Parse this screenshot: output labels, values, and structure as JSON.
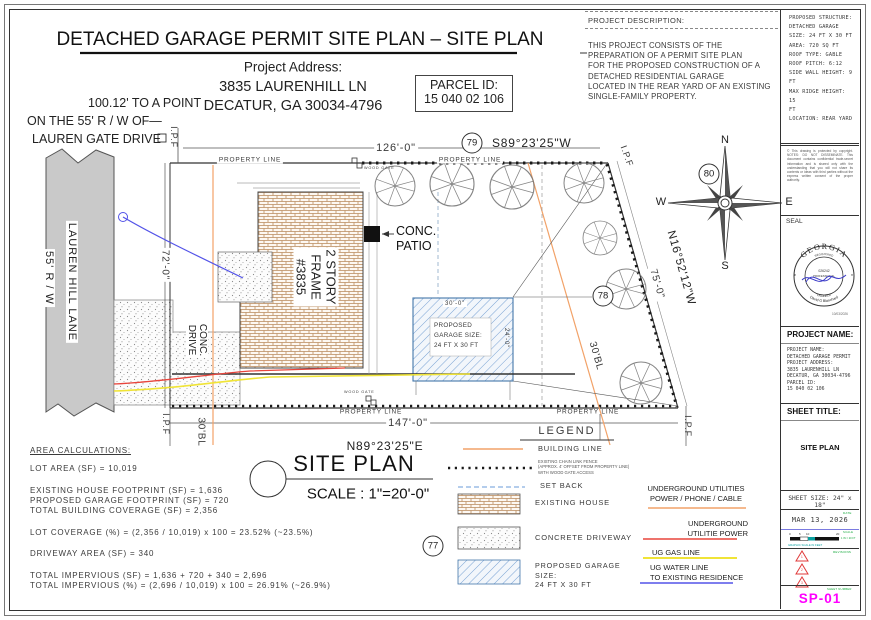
{
  "header": {
    "title": "DETACHED GARAGE PERMIT SITE PLAN – SITE PLAN",
    "address_label": "Project Address:",
    "address_line1": "3835 LAURENHILL LN",
    "address_line2": "DECATUR, GA 30034-4796",
    "parcel_label": "PARCEL ID:",
    "parcel_value": "15 040 02 106",
    "description_label": "PROJECT DESCRIPTION:",
    "description_lines": [
      "THIS PROJECT CONSISTS OF THE",
      "PREPARATION OF A PERMIT SITE PLAN",
      "FOR THE PROPOSED CONSTRUCTION OF A",
      "DETACHED RESIDENTIAL GARAGE",
      "LOCATED IN THE REAR YARD OF AN EXISTING",
      "SINGLE-FAMILY PROPERTY."
    ],
    "left_note_line1": "100.12' TO A POINT",
    "left_note_line2": "ON THE 55' R / W OF—",
    "left_note_line3": "LAUREN GATE DRIVE"
  },
  "drawing": {
    "property_line": "PROPERTY LINE",
    "ipf": "I.P.F",
    "dim_top": "126'-0\"",
    "dim_bottom": "147'-0\"",
    "dim_left": "72'-0\"",
    "dim_right": "75'-0\"",
    "bearing_top": "S89°23'25\"W",
    "bearing_bottom": "N89°23'25\"E",
    "bearing_right": "N16°52'12\"W",
    "bl_label": "30'BL",
    "road_name": "LAUREN HILL LANE",
    "road_rw": "55' R / W",
    "house_line1": "2 STORY",
    "house_line2": "FRAME",
    "house_line3": "#3835",
    "conc_drive_line1": "CONC.",
    "conc_drive_line2": "DRIVE",
    "conc_patio_line1": "CONC.",
    "conc_patio_line2": "PATIO",
    "garage_dim_w": "30'-0\"",
    "garage_dim_h": "24'-0\"",
    "garage_line1": "PROPOSED",
    "garage_line2": "GARAGE SIZE:",
    "garage_line3": "24 FT X 30 FT",
    "wood_gate": "WOOD GATE",
    "circle_77": "77",
    "circle_78": "78",
    "circle_79": "79",
    "circle_80": "80",
    "compass_n": "N",
    "compass_e": "E",
    "compass_s": "S",
    "compass_w": "W",
    "site_plan_title": "SITE PLAN",
    "site_plan_scale": "SCALE : 1\"=20'-0\"",
    "area_calcs": {
      "title": "AREA CALCULATIONS:",
      "lines": [
        "LOT AREA (SF) = 10,019",
        "EXISTING HOUSE FOOTPRINT (SF) = 1,636",
        "PROPOSED GARAGE FOOTPRINT (SF) = 720",
        "TOTAL BUILDING COVERAGE (SF) = 2,356",
        "LOT COVERAGE (%) = (2,356 / 10,019) x 100 = 23.52%  (~23.5%)",
        "DRIVEWAY AREA (SF) = 340",
        "TOTAL IMPERVIOUS (SF) = 1,636 + 720 + 340 = 2,696",
        "TOTAL IMPERVIOUS (%) = (2,696 / 10,019) x 100 = 26.91%  (~26.9%)"
      ]
    },
    "legend": {
      "title": "LEGEND",
      "building_line": "BUILDING LINE",
      "fence_line1": "EXISTING CHAIN LINK FENCE",
      "fence_line2": "(APPROX. 4' OFFSET FROM PROPERTY LINE)",
      "fence_line3": "WITH WOOD GATE ACCESS",
      "set_back": "SET BACK",
      "existing_house": "EXISTING HOUSE",
      "concrete_driveway": "CONCRETE DRIVEWAY",
      "proposed_garage_line1": "PROPOSED GARAGE",
      "proposed_garage_line2": "SIZE:",
      "proposed_garage_line3": "24 FT X 30 FT",
      "util1_line1": "UNDERGROUND UTILITIES",
      "util1_line2": "POWER / PHONE / CABLE",
      "util2_line1": "UNDERGROUND",
      "util2_line2": "UTILITIE POWER",
      "util3": "UG GAS LINE",
      "util4_line1": "UG WATER LINE",
      "util4_line2": "TO EXISTING RESIDENCE"
    }
  },
  "sidebar": {
    "structure_lines": [
      "PROPOSED STRUCTURE:",
      "DETACHED GARAGE",
      "",
      "SIZE: 24 FT X 30 FT",
      "AREA: 720 SQ FT",
      "",
      "ROOF TYPE: GABLE",
      "ROOF PITCH: 6:12",
      "",
      "SIDE WALL HEIGHT: 9 FT",
      "MAX RIDGE HEIGHT: 15",
      "FT",
      "",
      "LOCATION: REAR YARD"
    ],
    "copyright": "© This drawing is protected by copyright. NOTES: DO NOT DISSEMINATE. This document contains confidential trade-secret information and is shared only with the understanding that you will not share its contents or ideas with third parties without the express written consent of the proper authority.",
    "seal_label": "SEAL",
    "seal_state": "GEORGIA",
    "seal_registered": "REGISTERED",
    "seal_number": "026242",
    "seal_profession": "PROFESSIONAL",
    "seal_engineer": "ENGINEER",
    "seal_name": "David G Blanchard",
    "seal_date": "10/03/2026",
    "project_name_header": "PROJECT NAME:",
    "project_lines": [
      "PROJECT NAME:",
      "DETACHED GARAGE PERMIT",
      "",
      "PROJECT ADDRESS:",
      "3835 LAURENHILL LN",
      "DECATUR, GA 30034-4796",
      "PARCEL ID:",
      "15 040 02 106"
    ],
    "sheet_title_header": "SHEET TITLE:",
    "sheet_title_value": "SITE PLAN",
    "sheet_size": "SHEET SIZE: 24\" x 18\"",
    "date_label": "DATE",
    "date_value": "MAR 13, 2026",
    "scale_label": "SCALE",
    "scale_tick_0": "0",
    "scale_tick_5": "5",
    "scale_tick_10": "10",
    "scale_tick_20": "20",
    "scale_note": "1 IN = 20 FT",
    "scale_caption": "GRAPHIC SCALE IN FEET",
    "revisions_label": "REVISIONS",
    "rev_1": "1",
    "rev_2": "2",
    "rev_3": "3",
    "sheet_number_label": "SHEET NUMBER",
    "sheet_number": "SP-01"
  },
  "colors": {
    "building_line": "#f2a268",
    "gas_line": "#f0e437",
    "power_line": "#e8453c",
    "water_line": "#5353e8",
    "utilities_line": "#f2a268",
    "sheet_number": "#ff00ff",
    "green_label": "#16a83c",
    "revision_red": "#e03a3a",
    "road_fill": "#c9c9c9",
    "garage_hatch": "#7aa3d4",
    "brick_hatch": "#b98a5c"
  }
}
